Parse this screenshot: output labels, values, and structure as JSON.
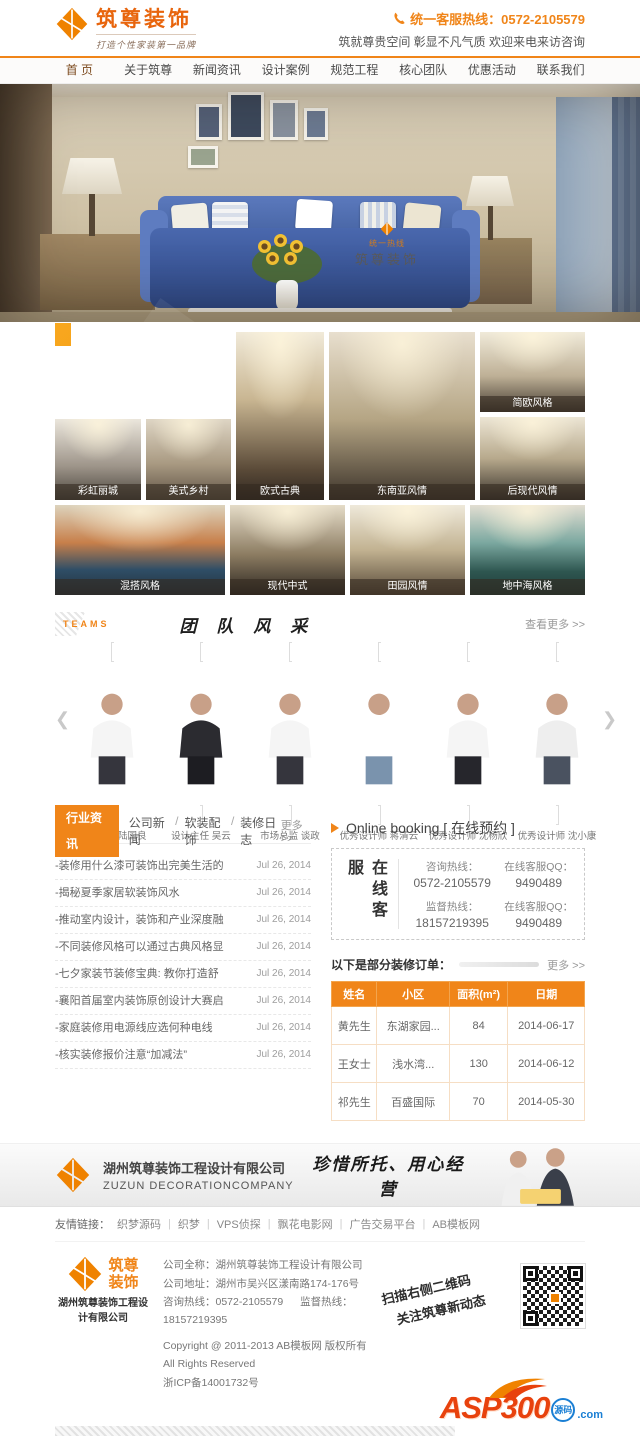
{
  "header": {
    "logo_title": "筑尊装饰",
    "logo_tagline": "打造个性家装第一品牌",
    "hotline": "统一客服热线：0572-2105579",
    "slogan": "筑就尊贵空间 彰显不凡气质 欢迎来电来访咨询"
  },
  "nav": {
    "items": [
      "首 页",
      "关于筑尊",
      "新闻资讯",
      "设计案例",
      "规范工程",
      "核心团队",
      "优惠活动",
      "联系我们"
    ]
  },
  "hero": {
    "watermark_brand": "筑尊装饰",
    "watermark_small": "统一热线"
  },
  "cases": {
    "en_line1": "CLASSIC",
    "en_line2": "CASES",
    "cn_title": "经典案例",
    "items": [
      "彩虹丽城",
      "美式乡村",
      "欧式古典",
      "东南亚风情",
      "简欧风格",
      "后现代风情",
      "混搭风格",
      "现代中式",
      "田园风情",
      "地中海风格"
    ]
  },
  "team": {
    "label_en": "TEAMS",
    "title": "团 队 风 采",
    "more": "查看更多 >>",
    "prev_icon": "❮",
    "next_icon": "❯",
    "members": [
      {
        "caption": "设计总监 陆国良"
      },
      {
        "caption": "设计主任 吴云"
      },
      {
        "caption": "市场总监 谈政"
      },
      {
        "caption": "优秀设计师 蒋清云"
      },
      {
        "caption": "优秀设计师 沈杨欣"
      },
      {
        "caption": "优秀设计师 沈小康"
      }
    ]
  },
  "news": {
    "active_tab": "行业资讯",
    "tabs": [
      "公司新闻",
      "软装配饰",
      "装修日志"
    ],
    "tab_separator": "/",
    "more": "更多>>",
    "items": [
      {
        "title": "-装修用什么漆可装饰出完美生活的",
        "date": "Jul 26, 2014"
      },
      {
        "title": "-揭秘夏季家居软装饰风水",
        "date": "Jul 26, 2014"
      },
      {
        "title": "-推动室内设计，装饰和产业深度融",
        "date": "Jul 26, 2014"
      },
      {
        "title": "-不同装修风格可以通过古典风格显",
        "date": "Jul 26, 2014"
      },
      {
        "title": "-七夕家装节装修宝典: 教你打造舒",
        "date": "Jul 26, 2014"
      },
      {
        "title": "-襄阳首届室内装饰原创设计大赛启",
        "date": "Jul 26, 2014"
      },
      {
        "title": "-家庭装修用电源线应选何种电线",
        "date": "Jul 26, 2014"
      },
      {
        "title": "-核实装修报价注意“加减法”",
        "date": "Jul 26, 2014"
      }
    ]
  },
  "booking": {
    "title": "Online booking [ 在线预约 ]",
    "vertical_label": "在线客服",
    "cells": [
      {
        "label": "咨询热线：",
        "value": "0572-2105579"
      },
      {
        "label": "在线客服QQ：",
        "value": "9490489"
      },
      {
        "label": "监督热线：",
        "value": "18157219395"
      },
      {
        "label": "在线客服QQ：",
        "value": "9490489"
      }
    ],
    "orders_label": "以下是部分装修订单：",
    "orders_more": "更多 >>",
    "table": {
      "headers": [
        "姓名",
        "小区",
        "面积(m²)",
        "日期"
      ],
      "rows": [
        [
          "黄先生",
          "东湖家园...",
          "84",
          "2014-06-17"
        ],
        [
          "王女士",
          "浅水湾...",
          "130",
          "2014-06-12"
        ],
        [
          "祁先生",
          "百盛国际",
          "70",
          "2014-05-30"
        ]
      ]
    }
  },
  "banner": {
    "company_cn": "湖州筑尊装饰工程设计有限公司",
    "company_en": "ZUZUN DECORATIONCOMPANY",
    "slogan": "珍惜所托、用心经营"
  },
  "links": {
    "label": "友情链接：",
    "separator": "|",
    "items": [
      "织梦源码",
      "织梦",
      "VPS侦探",
      "飘花电影网",
      "广告交易平台",
      "AB模板网"
    ]
  },
  "footer": {
    "logo_line1": "筑尊",
    "logo_line2": "装饰",
    "logo_company": "湖州筑尊装饰工程设计有限公司",
    "full_name": "公司全称：湖州筑尊装饰工程设计有限公司",
    "address": "公司地址：湖州市吴兴区漾南路174-176号",
    "hotline1": "咨询热线：0572-2105579",
    "hotline2": "监督热线：18157219395",
    "copyright": "Copyright @ 2011-2013 AB模板网 版权所有 All Rights Reserved",
    "icp": "浙ICP备14001732号",
    "qr_tip_line1": "扫描右侧二维码",
    "qr_tip_line2": "关注筑尊新动态",
    "asp_text": "ASP300",
    "asp_suffix": "源码",
    "asp_domain": ".com"
  }
}
